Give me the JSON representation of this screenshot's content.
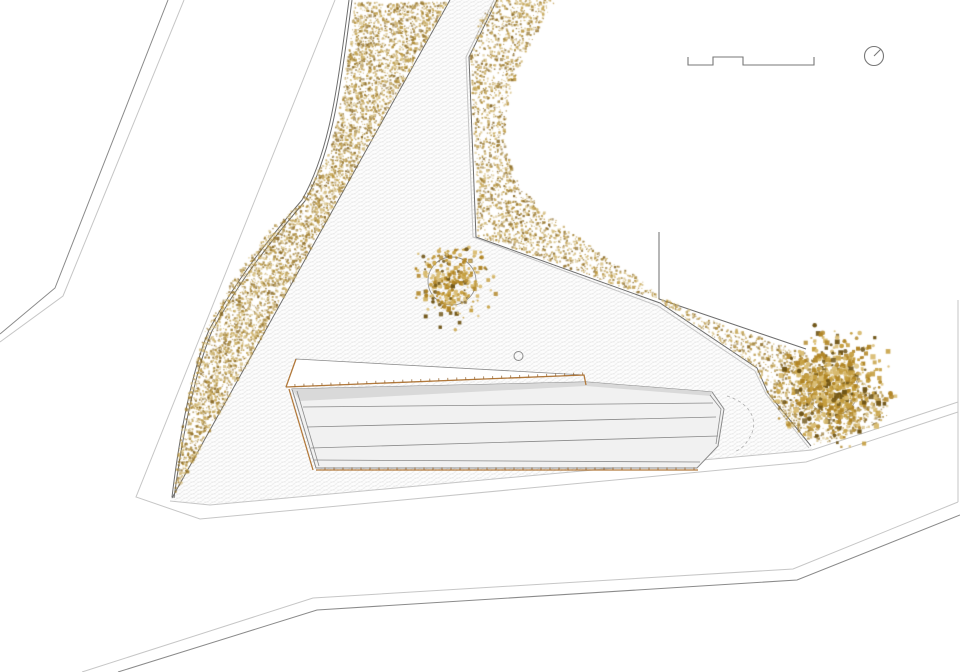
{
  "document": {
    "kind": "architectural-site-plan",
    "has_visible_text": false,
    "annotations": [
      "scale-bar",
      "north-arrow"
    ]
  },
  "palette": {
    "background": "#ffffff",
    "line_dark": "#6e6e6e",
    "line_mid": "#8a8a8a",
    "line_light": "#c6c6c6",
    "hatch_line": "#e4e4e4",
    "hatch_line2": "#ededed",
    "roof_fill": "#f1f1f1",
    "roof_band": "#d9d9d9",
    "timber_edge": "#b2793b",
    "timber_edge_dark": "#8a5a25",
    "stipple_palette": [
      "#c9ab5e",
      "#b8943f",
      "#a07f33",
      "#8a6a28",
      "#d6c084"
    ],
    "tree_palette": [
      "#c59e3f",
      "#b08424",
      "#d9bc72",
      "#6f5416",
      "#9c7c2e"
    ]
  },
  "features": [
    "road-upper-left",
    "gravel-band-west",
    "paved-plaza",
    "gravel-area-east",
    "building-roof",
    "tree-plaza",
    "tree-east",
    "road-bottom",
    "road-east",
    "plaza-drain-circle",
    "door-swing-arc"
  ]
}
